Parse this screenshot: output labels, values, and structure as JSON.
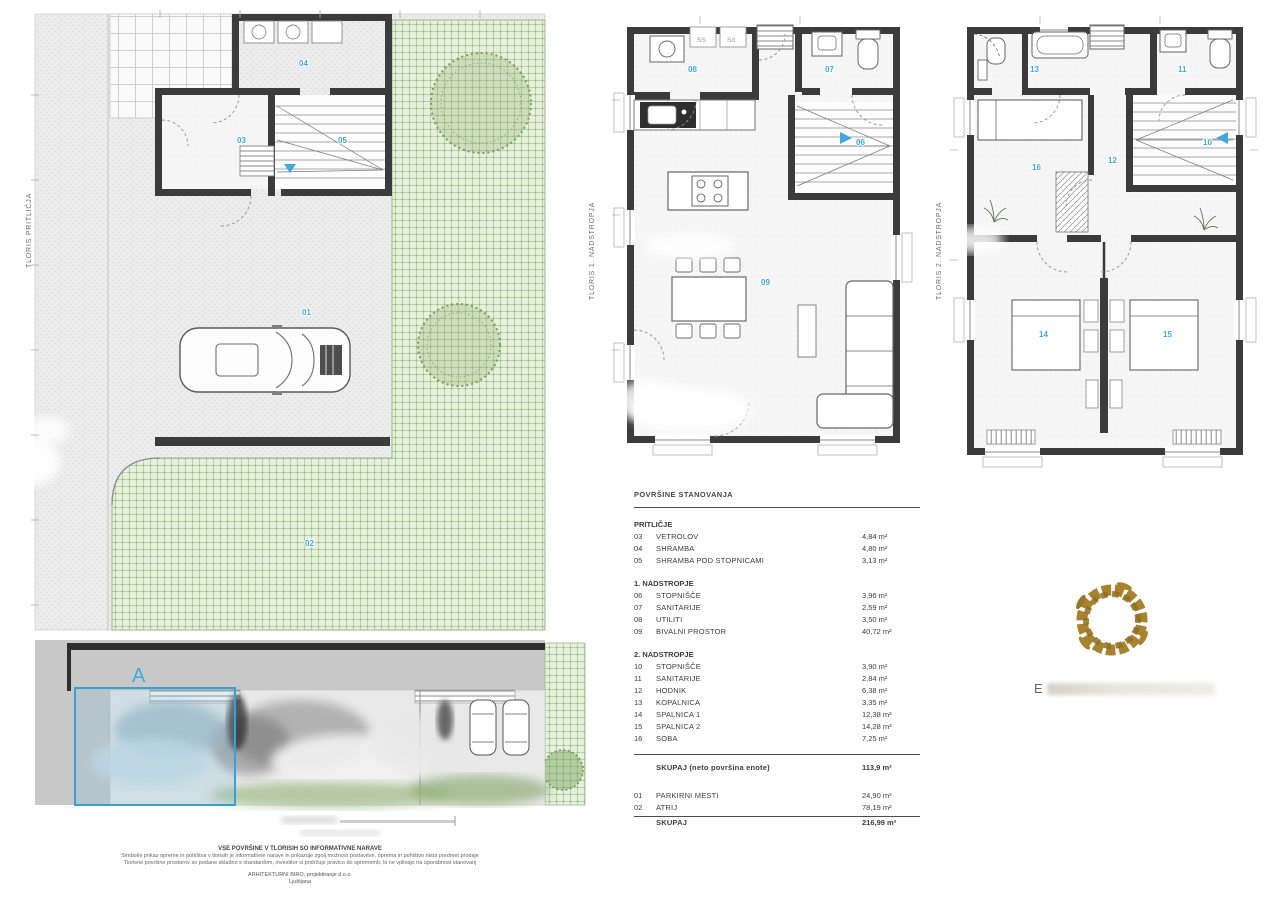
{
  "plans": {
    "ground": {
      "title": "TLORIS PRITLIČJA",
      "labels": [
        "01",
        "02",
        "03",
        "04",
        "05"
      ]
    },
    "first": {
      "title": "TLORIS 1. NADSTROPJA",
      "labels": [
        "06",
        "07",
        "08",
        "09"
      ],
      "appliances": [
        "SS",
        "Sd"
      ]
    },
    "second": {
      "title": "TLORIS 2. NADSTROPJA",
      "labels": [
        "10",
        "11",
        "12",
        "13",
        "14",
        "15",
        "16"
      ]
    }
  },
  "site_plan": {
    "unit_label": "A"
  },
  "area_table": {
    "title": "POVRŠINE STANOVANJA",
    "sections": [
      {
        "heading": "PRITLIČJE",
        "rows": [
          [
            "03",
            "VETROLOV",
            "4,84 m²"
          ],
          [
            "04",
            "SHRAMBA",
            "4,80 m²"
          ],
          [
            "05",
            "SHRAMBA POD STOPNICAMI",
            "3,13 m²"
          ]
        ]
      },
      {
        "heading": "1. NADSTROPJE",
        "rows": [
          [
            "06",
            "STOPNIŠČE",
            "3,96 m²"
          ],
          [
            "07",
            "SANITARIJE",
            "2,59 m²"
          ],
          [
            "08",
            "UTILITI",
            "3,50 m²"
          ],
          [
            "09",
            "BIVALNI PROSTOR",
            "40,72 m²"
          ]
        ]
      },
      {
        "heading": "2. NADSTROPJE",
        "rows": [
          [
            "10",
            "STOPNIŠČE",
            "3,90 m²"
          ],
          [
            "11",
            "SANITARIJE",
            "2,84 m²"
          ],
          [
            "12",
            "HODNIK",
            "6,38 m²"
          ],
          [
            "13",
            "KOPALNICA",
            "3,35 m²"
          ],
          [
            "14",
            "SPALNICA 1",
            "12,38 m²"
          ],
          [
            "15",
            "SPALNICA 2",
            "14,28 m²"
          ],
          [
            "16",
            "SOBA",
            "7,25 m²"
          ]
        ]
      }
    ],
    "subtotal": {
      "name": "SKUPAJ (neto površina enote)",
      "area": "113,9 m²"
    },
    "extras": [
      [
        "01",
        "PARKIRNI MESTI",
        "24,90 m²"
      ],
      [
        "02",
        "ATRIJ",
        "78,19 m²"
      ]
    ],
    "total": {
      "name": "SKUPAJ",
      "area": "216,99 m²"
    }
  },
  "footnotes": {
    "line1": "VSE POVRŠINE V TLORISIH SO INFORMATIVNE NARAVE",
    "line2": "Simbolni prikaz opreme in pohištva v tlorisih je informativne narave in prikazuje zgolj možnost postavitve, oprema in pohištvo nista predmet prodaje",
    "line3": "Tlorisne površine prostorov so podane skladno s standardom, investitor si pridržuje pravico do sprememb, ki ne vplivajo na uporabnost stanovanj",
    "line4": "ARHITEKTURNI BIRO, projektiranje d.o.o.",
    "line5": "Ljubljana"
  },
  "logo": {
    "visible_letter": "E"
  }
}
